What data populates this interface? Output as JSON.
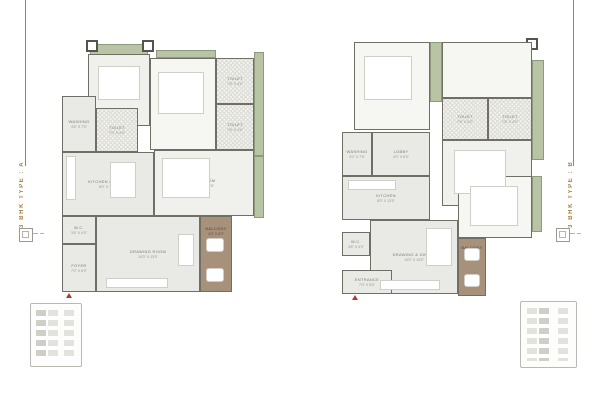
{
  "page": {
    "background": "#ffffff"
  },
  "colors": {
    "accent_gold": "#a5813f",
    "floor_gray": "#e9e9e5",
    "floor_light": "#f6f6f3",
    "terrace_green": "#b9c3a6",
    "balcony_brown": "#a8917b",
    "wall": "#6f6f66",
    "entrance_red": "#b03a2e"
  },
  "side_labels": {
    "left": "3 BHK TYPE : A",
    "right": "3 BHK TYPE : B"
  },
  "plans": {
    "a": {
      "rooms": [
        {
          "name": "BEDROOM",
          "dim": "12'0\" X 11'6\""
        },
        {
          "name": "BEDROOM",
          "dim": "11'6\" X 13'0\""
        },
        {
          "name": "TOILET",
          "dim": "7'6\" X 4'0\""
        },
        {
          "name": "TOILET",
          "dim": "7'6\" X 4'0\""
        },
        {
          "name": "WASHING",
          "dim": "3'6\" X 7'0\""
        },
        {
          "name": "TOILET",
          "dim": "7'0\" X 4'0\""
        },
        {
          "name": "BEDROOM",
          "dim": "12'0\" X 13'6\""
        },
        {
          "name": "KITCHEN / DINING",
          "dim": "8'0\" X 12'6\""
        },
        {
          "name": "W.C.",
          "dim": "3'6\" X 4'0\""
        },
        {
          "name": "DRAWING ROOM",
          "dim": "14'0\" X 13'0\""
        },
        {
          "name": "BALCONY",
          "dim": "4'0\" X 8'0\""
        },
        {
          "name": "FOYER",
          "dim": "7'0\" X 6'0\""
        }
      ]
    },
    "b": {
      "rooms": [
        {
          "name": "BEDROOM",
          "dim": "11'0\" X 12'0\""
        },
        {
          "name": "TOILET",
          "dim": "7'6\" X 4'0\""
        },
        {
          "name": "TOILET",
          "dim": "7'6\" X 4'0\""
        },
        {
          "name": "BEDROOM",
          "dim": "12'0\" X 13'0\""
        },
        {
          "name": "WASHING",
          "dim": "3'0\" X 7'6\""
        },
        {
          "name": "LOBBY",
          "dim": "4'0\" X 6'0\""
        },
        {
          "name": "KITCHEN",
          "dim": "8'0\" X 12'0\""
        },
        {
          "name": "DRAWING & DINING",
          "dim": "14'0\" X 19'0\""
        },
        {
          "name": "BEDROOM",
          "dim": "11'0\" X 12'0\""
        },
        {
          "name": "BALCONY",
          "dim": "4'0\" X 8'0\""
        },
        {
          "name": "W.C.",
          "dim": "3'6\" X 4'0\""
        },
        {
          "name": "ENTRANCE",
          "dim": "7'0\" X 5'0\""
        }
      ]
    }
  }
}
